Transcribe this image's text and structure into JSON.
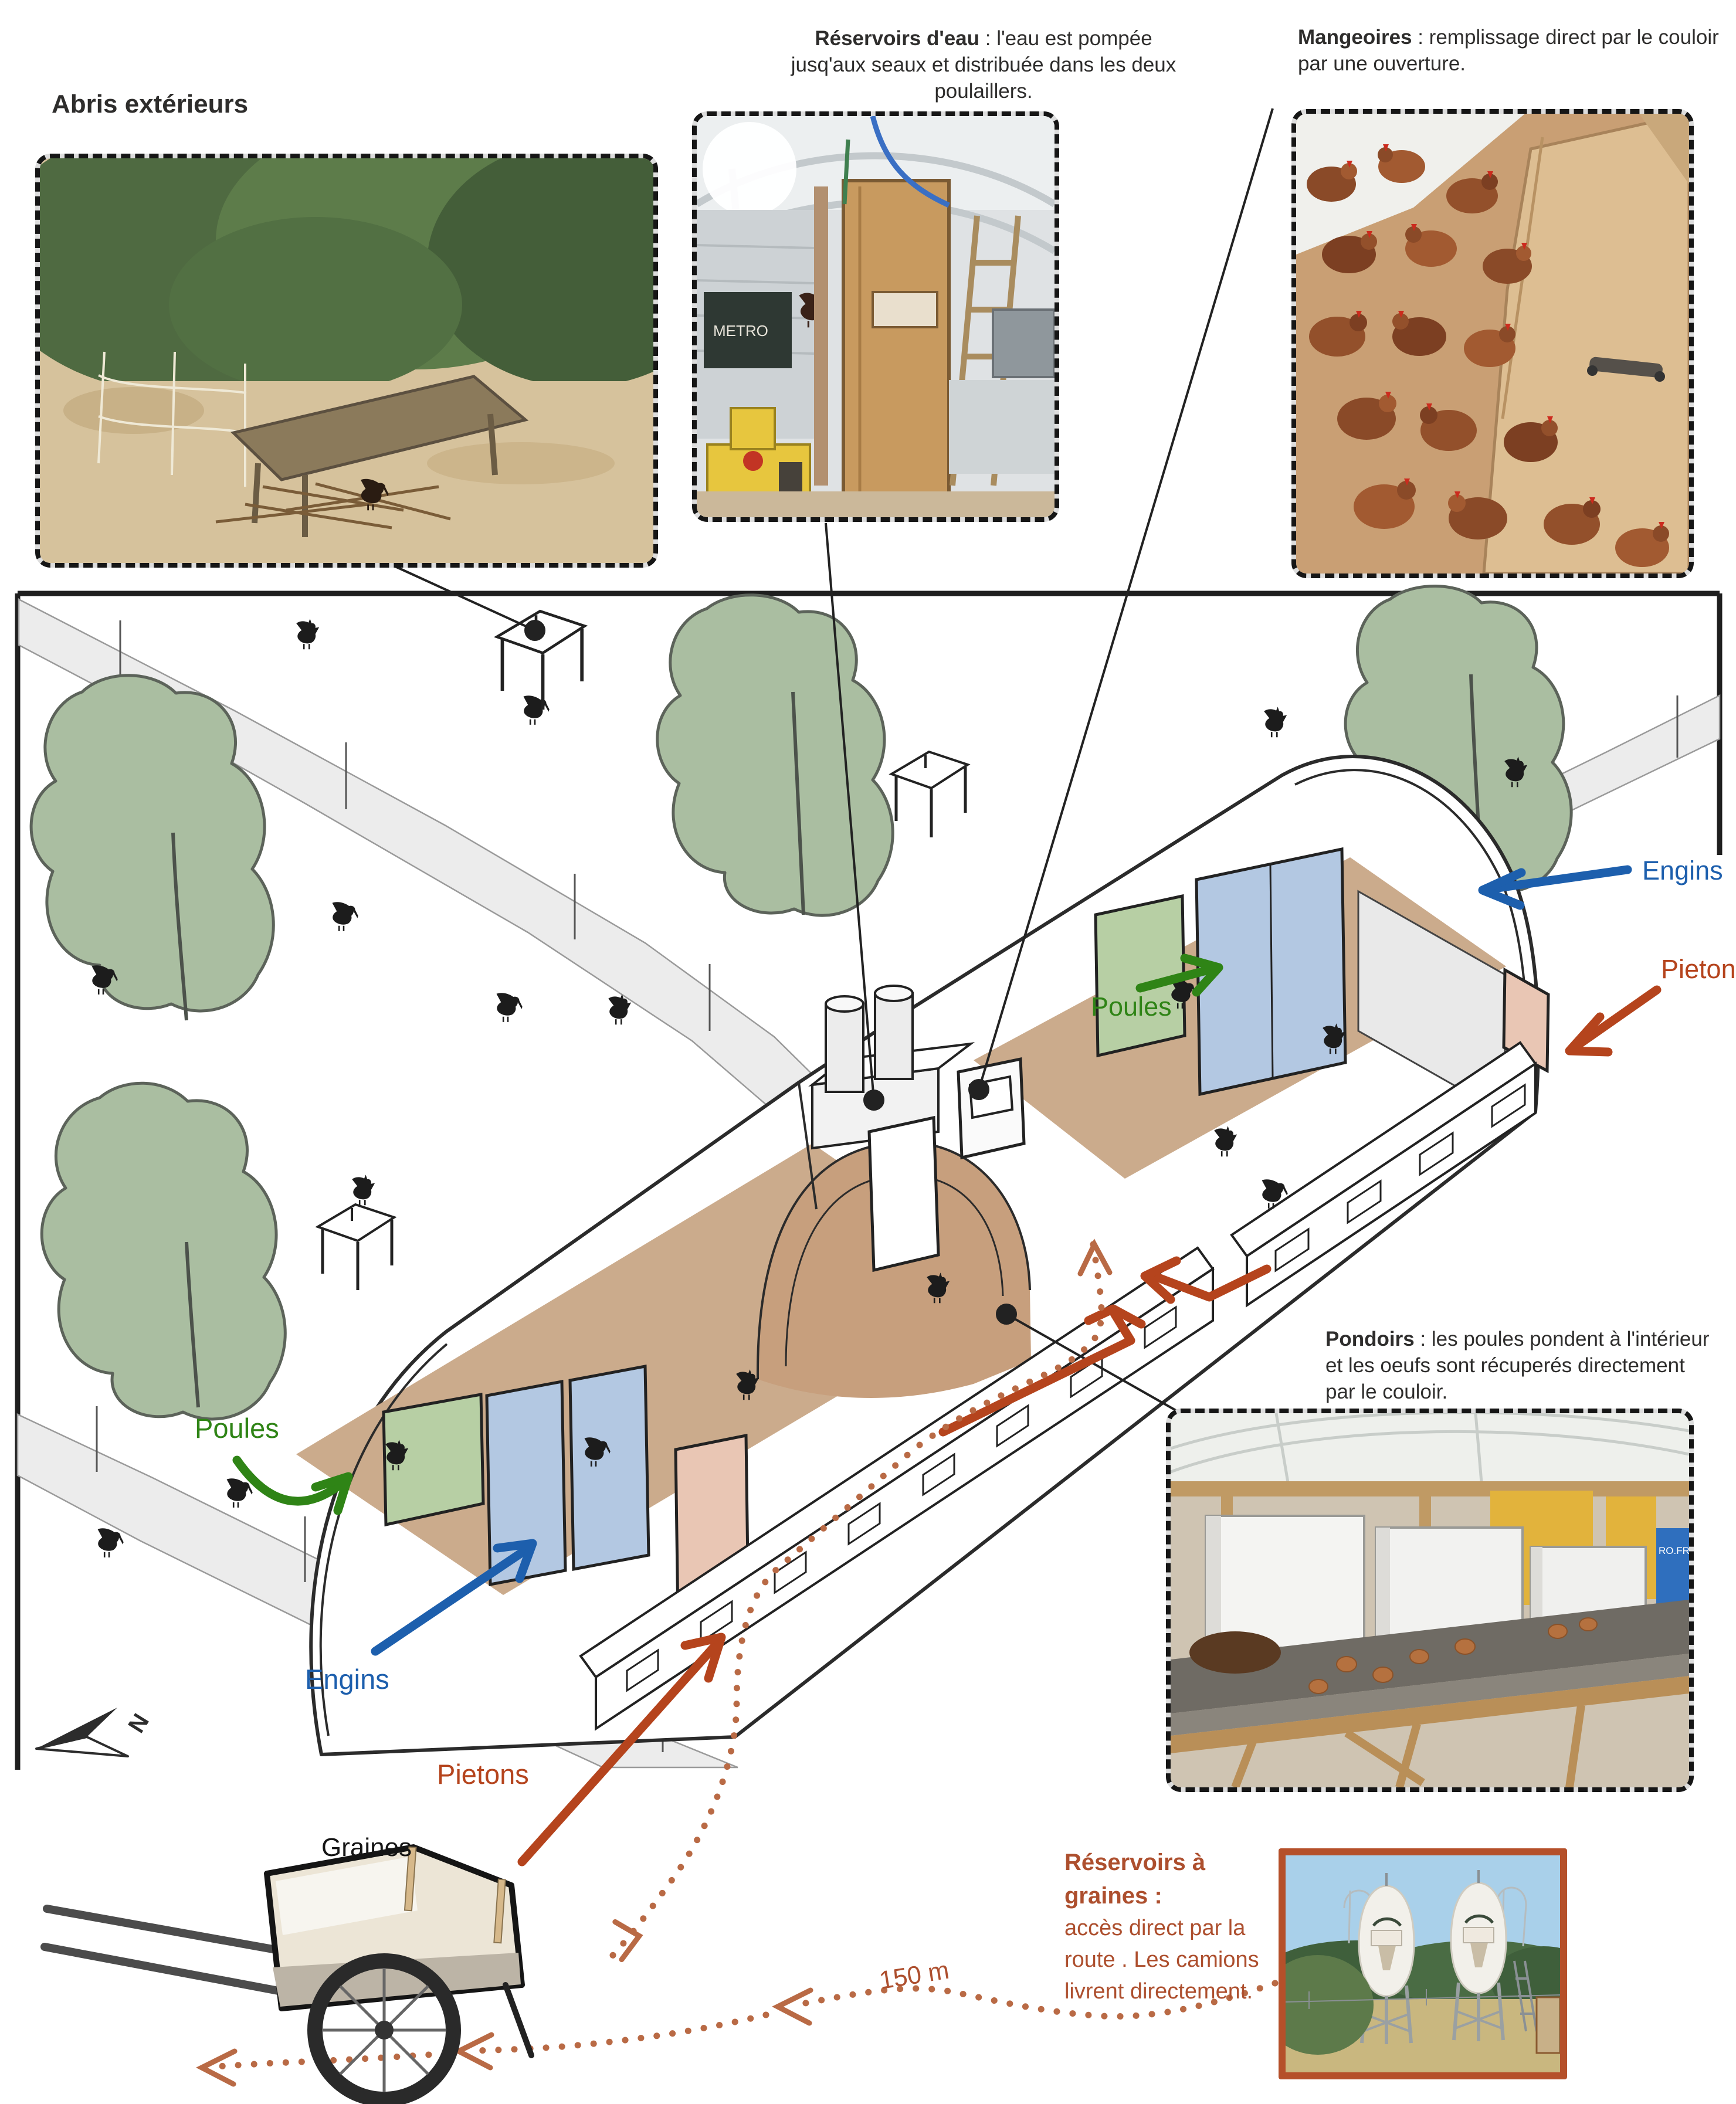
{
  "page": {
    "background": "#ffffff"
  },
  "photos": {
    "abris": {
      "caption": "Abris extérieurs"
    },
    "eau": {
      "head": "Réservoirs d'eau",
      "body": " : l'eau est pompée jusq'aux seaux et distribuée dans les deux poulaillers.",
      "sign": "METRO"
    },
    "mangeoires": {
      "head": "Mangeoires",
      "body": " : remplissage direct par le couloir par une ouverture."
    },
    "pondoirs": {
      "head": "Pondoirs",
      "body": " : les poules pondent à l'intérieur et les oeufs sont récuperés directement par le couloir.",
      "box_text": "RO.FR"
    },
    "graines": {
      "head": "Réservoirs à graines :",
      "lines": [
        "accès direct par la",
        "route . Les camions",
        "livrent directement."
      ]
    }
  },
  "plan": {
    "labels": {
      "poules_left": "Poules",
      "poules_center": "Poules",
      "engins_left": "Engins",
      "engins_right": "Engins",
      "pietons_bottom": "Pietons",
      "pietons_right": "Pietons",
      "cart": "Graines",
      "distance": "150 m",
      "north": "N"
    },
    "colors": {
      "poules_green": "#2f8416",
      "engins_blue": "#1d5fad",
      "pietons_rust": "#b5441d",
      "route_dotted": "#b96a45",
      "floor_tan": "#cbab8c",
      "corridor_tan": "#c79f7d",
      "door_blue": "#b3c8e2",
      "door_green": "#b7cfa4",
      "door_pink": "#e9c6b4",
      "tree_green": "#aabea1",
      "road_grey": "#ececec"
    }
  }
}
